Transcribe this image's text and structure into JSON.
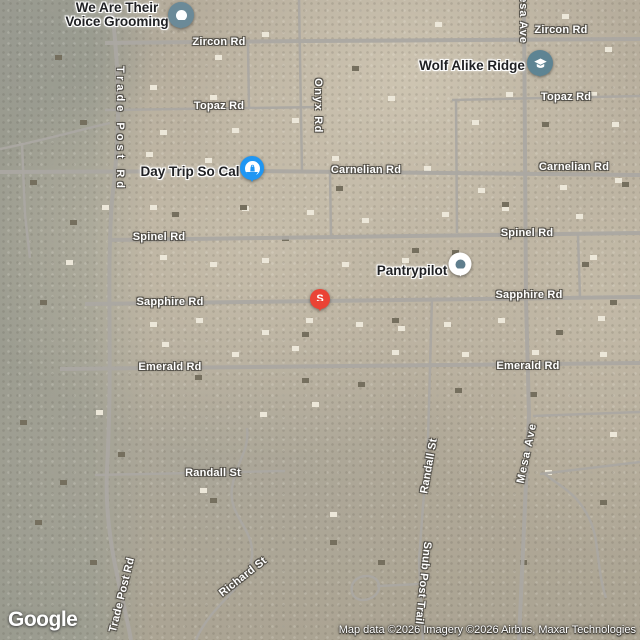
{
  "branding": {
    "logo": "Google"
  },
  "attribution": "Map data ©2026 Imagery ©2026 Airbus, Maxar Technologies",
  "roads": {
    "zircon": "Zircon Rd",
    "topaz": "Topaz Rd",
    "onyx": "Onyx Rd",
    "carnelian": "Carnelian Rd",
    "spinel": "Spinel Rd",
    "sapphire": "Sapphire Rd",
    "emerald": "Emerald Rd",
    "trade_post": "Trade Post Rd",
    "mesa": "Mesa Ave",
    "randall": "Randall St",
    "richard": "Richard St",
    "snub_post": "Snub Post Trail"
  },
  "places": {
    "grooming": {
      "name": "We Are Their Voice Grooming",
      "line1": "We Are Their",
      "line2": "Voice Grooming",
      "marker": "circle-pin",
      "marker_color": "#6b8a98"
    },
    "wolf_ridge": {
      "name": "Wolf Alike Ridge",
      "marker": "school-pin",
      "marker_color": "#5e8493"
    },
    "day_trip": {
      "name": "Day Trip So Cal",
      "marker": "shopping-pin",
      "marker_color": "#1e96f3"
    },
    "pantry": {
      "name": "Pantrypilot",
      "marker": "dot-pin",
      "marker_color": "#5f7e8d"
    },
    "search_result": {
      "letter": "S",
      "marker": "red-pin",
      "marker_color": "#ea4335"
    }
  }
}
